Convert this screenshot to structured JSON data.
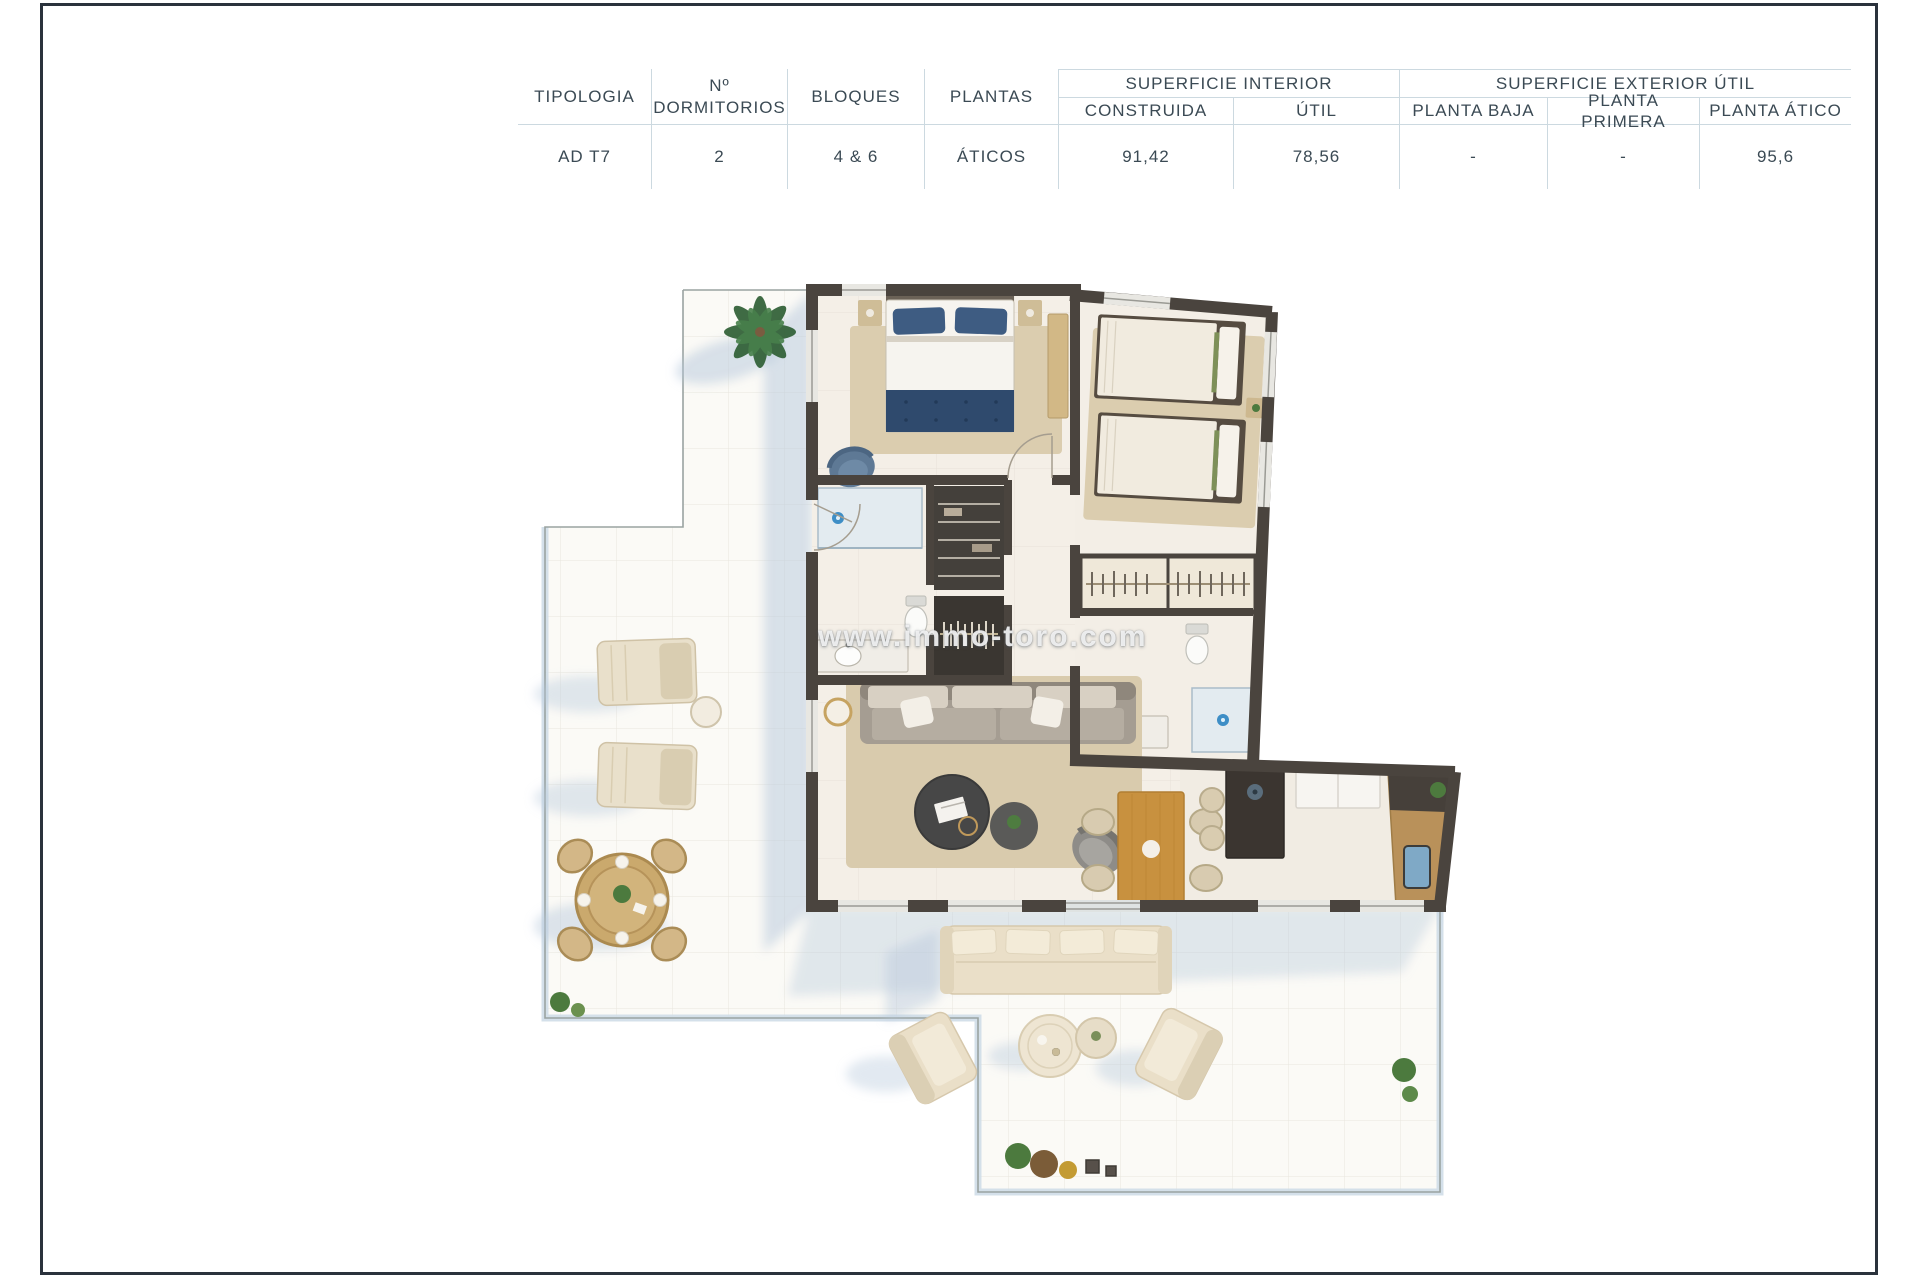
{
  "page": {
    "frame_color": "#2a323c",
    "background": "#ffffff"
  },
  "table": {
    "group_headers": [
      {
        "label": "SUPERFICIE INTERIOR"
      },
      {
        "label": "SUPERFICIE EXTERIOR ÚTIL"
      }
    ],
    "columns": [
      {
        "label": "TIPOLOGIA"
      },
      {
        "label": "Nº DORMITORIOS"
      },
      {
        "label": "BLOQUES"
      },
      {
        "label": "PLANTAS"
      },
      {
        "label": "CONSTRUIDA"
      },
      {
        "label": "ÚTIL"
      },
      {
        "label": "PLANTA BAJA"
      },
      {
        "label": "PLANTA PRIMERA"
      },
      {
        "label": "PLANTA ÁTICO"
      }
    ],
    "row": {
      "tipologia": "AD T7",
      "dormitorios": "2",
      "bloques": "4 & 6",
      "plantas": "ÁTICOS",
      "construida": "91,42",
      "util": "78,56",
      "planta_baja": "-",
      "planta_primera": "-",
      "planta_atico": "95,6"
    }
  },
  "watermark": {
    "text": "www.immo-toro.com"
  },
  "plan": {
    "colors": {
      "wall": "#4a443e",
      "interior_floor": "#f4efe7",
      "terrace": "#fbfaf6",
      "terrace_rail": "#cfdde8",
      "shadow": "#b6c7db",
      "rug": "#dbcdaf",
      "bed_navy": "#3e5c82",
      "wood": "#c8913f",
      "outdoor_cream": "#eadfc8",
      "plant_green": "#4c7a3e",
      "water_blue": "#3e8ec6"
    }
  }
}
